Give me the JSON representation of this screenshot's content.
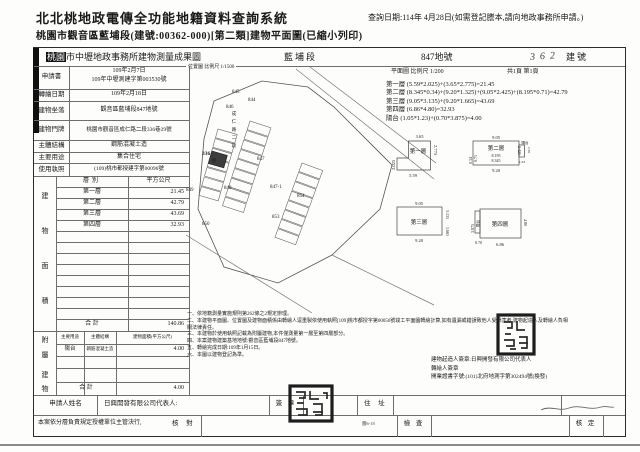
{
  "page": {
    "title": "北北桃地政電傳全功能地籍資料查詢系統",
    "subtitle": "桃園市觀音區藍埔段(建號:00362-000)[第二類]建物平面圖(已縮小列印)",
    "query_date": "查詢日期:114年 4月28日(如需登記謄本,請向地政事務所申請。)"
  },
  "form": {
    "office_prefix": "桃園",
    "office_title": "市中壢地政事務所建物測量成果圖",
    "section": "藍埔段",
    "parcel": "847地號",
    "building_no": "362",
    "building_no_label": "建號",
    "location_scale": "位置圖 比例尺 1/1500",
    "plan_scale": "平面圖 比例尺 1/200",
    "page_info": "共1頁 第1頁"
  },
  "info_rows": [
    {
      "label": "申請書",
      "value": "109年2月7日",
      "value2": "109年中壢測建字第003530號"
    },
    {
      "label": "轉繪日期",
      "value": "109年2月18日"
    },
    {
      "label": "建物坐落",
      "value": "觀音區藍埔段847地號"
    },
    {
      "label": "建物門牌",
      "value": "桃園市觀音區成仁路二段336巷29號"
    },
    {
      "label": "主體結構",
      "value": "鋼筋混凝土造"
    },
    {
      "label": "主要用途",
      "value": "集合住宅"
    },
    {
      "label": "使用執照",
      "value": "(109)桃市都授建字第00096號"
    }
  ],
  "area_table": {
    "side_chars": [
      "建",
      "物",
      "面",
      "積"
    ],
    "header": {
      "floor": "層別",
      "area": "平方公尺"
    },
    "rows": [
      {
        "floor": "第一層",
        "area": "21.45"
      },
      {
        "floor": "第二層",
        "area": "42.79"
      },
      {
        "floor": "第三層",
        "area": "43.69"
      },
      {
        "floor": "第四層",
        "area": "32.93"
      }
    ],
    "total_label": "合  計",
    "total": "140.86"
  },
  "annex_table": {
    "side_chars": [
      "附",
      "屬",
      "建",
      "物"
    ],
    "header": {
      "use": "主要用途",
      "structure": "主體結構",
      "area": "建物面積(平方公尺)"
    },
    "row": {
      "use": "陽台",
      "structure": "鋼筋混凝土造",
      "area": "4.00"
    },
    "total_label": "合  計",
    "total": "4.00"
  },
  "formulas": [
    "第一層 (5.59*2.025)+(3.65*2.775)=21.45",
    "第二層 (8.345*0.34)+(9.20*1.325)+(9.05*2.425)+(8.195*0.71)=42.79",
    "第三層 (9.05*3.135)+(9.20*1.665)=43.69",
    "第四層 (6.86*4.80)=32.93",
    "陽台 (1.05*1.23)+(0.70*3.875)=4.00"
  ],
  "notes": [
    "一、依地籍測量實施規則第262條之2規定辦理。",
    "二、本建物平面圖、位置圖及建物面積係由轉繪人逕重製依使用執照[109]桃市都授字第00056號竣工平面圖轉繪計算,如有遺漏或錯誤致他人受損害者,建物起造人及轉繪人負相關法律責任。",
    "三、本建物於使用執照記載為附屬建物,本件僅測量第一層至第四層部分。",
    "四、本案建物建築基地地號:觀音區藍埔段847地號。",
    "五、轉繪完成日期:109年1月15日。",
    "六、本圖以建物登記為準。"
  ],
  "signatures": {
    "builder": "建物起造人簽章:日興開發有限公司代表人",
    "transcriber": "轉繪人簽章",
    "license": "開業證書字號:(101)北府地測字第302494號(換發)"
  },
  "bottom": {
    "applicant_label": "申請人姓名",
    "applicant_value": "日興開發有限公司代表人:",
    "sign_label": "簽 章",
    "address_label": "住 址",
    "delegation": "本案依分層負責規定授權單位主管決行,",
    "review": "核 對",
    "inspect": "檢 查",
    "approve": "核 定",
    "fig_ref": "圖6-18"
  },
  "map": {
    "lots": [
      "845",
      "844",
      "846",
      "336",
      "847",
      "849",
      "848",
      "847-1",
      "854",
      "853",
      "850"
    ],
    "street_chars": [
      "成",
      "仁",
      "路",
      "二",
      "段",
      "巷"
    ]
  },
  "plans": {
    "p1": {
      "label": "第一層",
      "d_top": "3.65",
      "d_right": "2.775",
      "d_left": "2.025",
      "d_bottom": "5.59"
    },
    "p2": {
      "label": "第二層",
      "d_top": "9.05",
      "d_l1": "0.34",
      "d_l2": "0.71",
      "d_m1": "8.195",
      "d_m2": "8.345",
      "d_bottom": "9.20",
      "d_right": "2.425",
      "balcony": "陽台",
      "b1": "1.05",
      "b2": "1.23"
    },
    "p3": {
      "label": "第三層",
      "d_top": "9.05",
      "d_r1": "3.135",
      "d_r2": "1.665",
      "d_bottom": "9.20"
    },
    "p4": {
      "label": "第四層",
      "balcony": "陽台",
      "d_left": "3.875",
      "d_b1": "0.70",
      "d_bottom": "6.86",
      "d_right": "4.80"
    }
  }
}
